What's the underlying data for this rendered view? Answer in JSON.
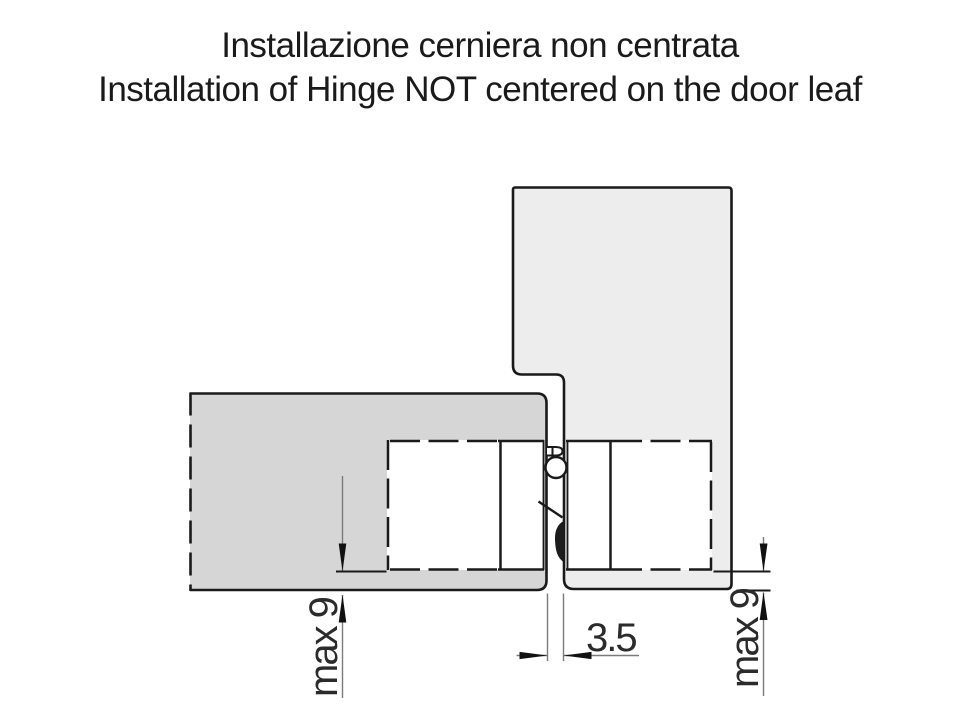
{
  "title": {
    "line1": "Installazione cerniera non centrata",
    "line2": "Installation of Hinge NOT centered on the door leaf"
  },
  "drawing": {
    "description": "Cross-section of hinge not centered on the door leaf",
    "dimensions": {
      "gap_label": "3.5",
      "left_offset_label": "max 9",
      "right_offset_label": "max 9"
    }
  },
  "colors": {
    "background": "#ffffff",
    "door_leaf_fill": "#d6d6d6",
    "frame_fill": "#ededed",
    "mortise_fill": "#ffffff",
    "outline": "#1a1a1a",
    "dim_line": "#7b7b7b",
    "dim_text": "#2b2b2b"
  }
}
